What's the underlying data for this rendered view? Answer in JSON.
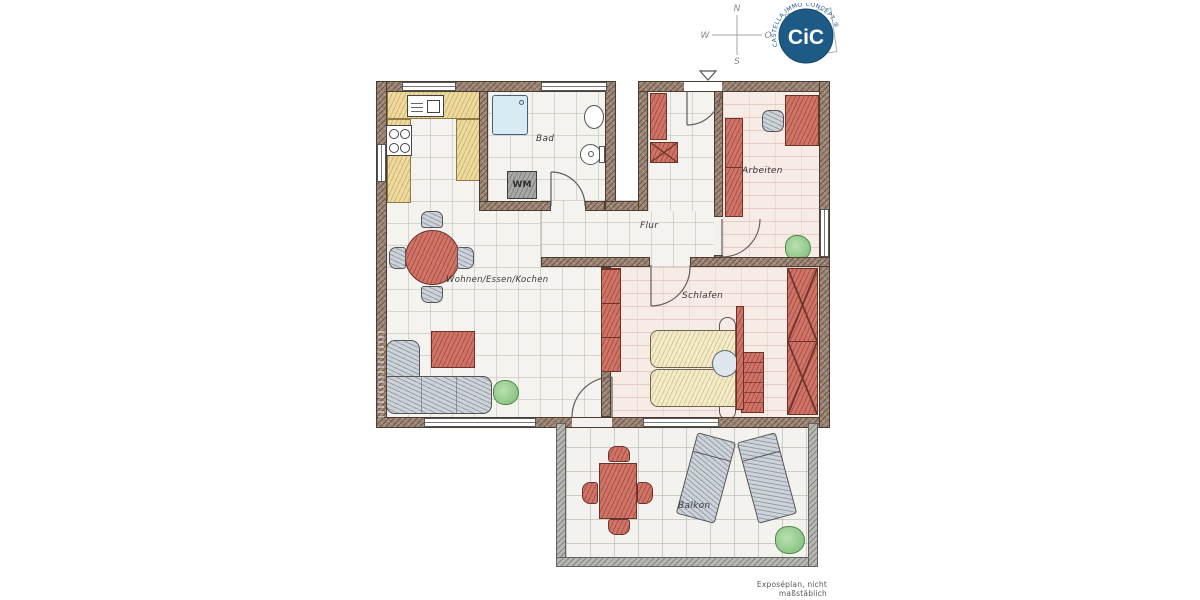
{
  "footer_note": "Exposéplan, nicht maßstäblich",
  "compass": {
    "north": "N",
    "east": "O",
    "south": "S",
    "west": "W"
  },
  "logo": {
    "monogram": "CiC",
    "ring_text": "CASTELLA IMMO CONCEPT ®"
  },
  "labels": {
    "living": "Wohnen/Essen/Kochen",
    "bath": "Bad",
    "hall": "Flur",
    "office": "Arbeiten",
    "bedroom": "Schlafen",
    "balcony": "Balkon",
    "washer": "WM"
  },
  "colors": {
    "wall_brown": "#9c8575",
    "balcony_wall_gray": "#b7b7b3",
    "furniture_red": "#cd7568",
    "kitchen_yellow": "#eeda9f",
    "upholstery_gray": "#cdd3d9",
    "bed_cream": "#f4ebc9",
    "floor_tile": "#f4f3f0",
    "floor_pink": "#f7ebe6",
    "shower_blue": "#d6ebf4",
    "plant_green": "#93ca8b",
    "logo_blue": "#1e5a86"
  }
}
